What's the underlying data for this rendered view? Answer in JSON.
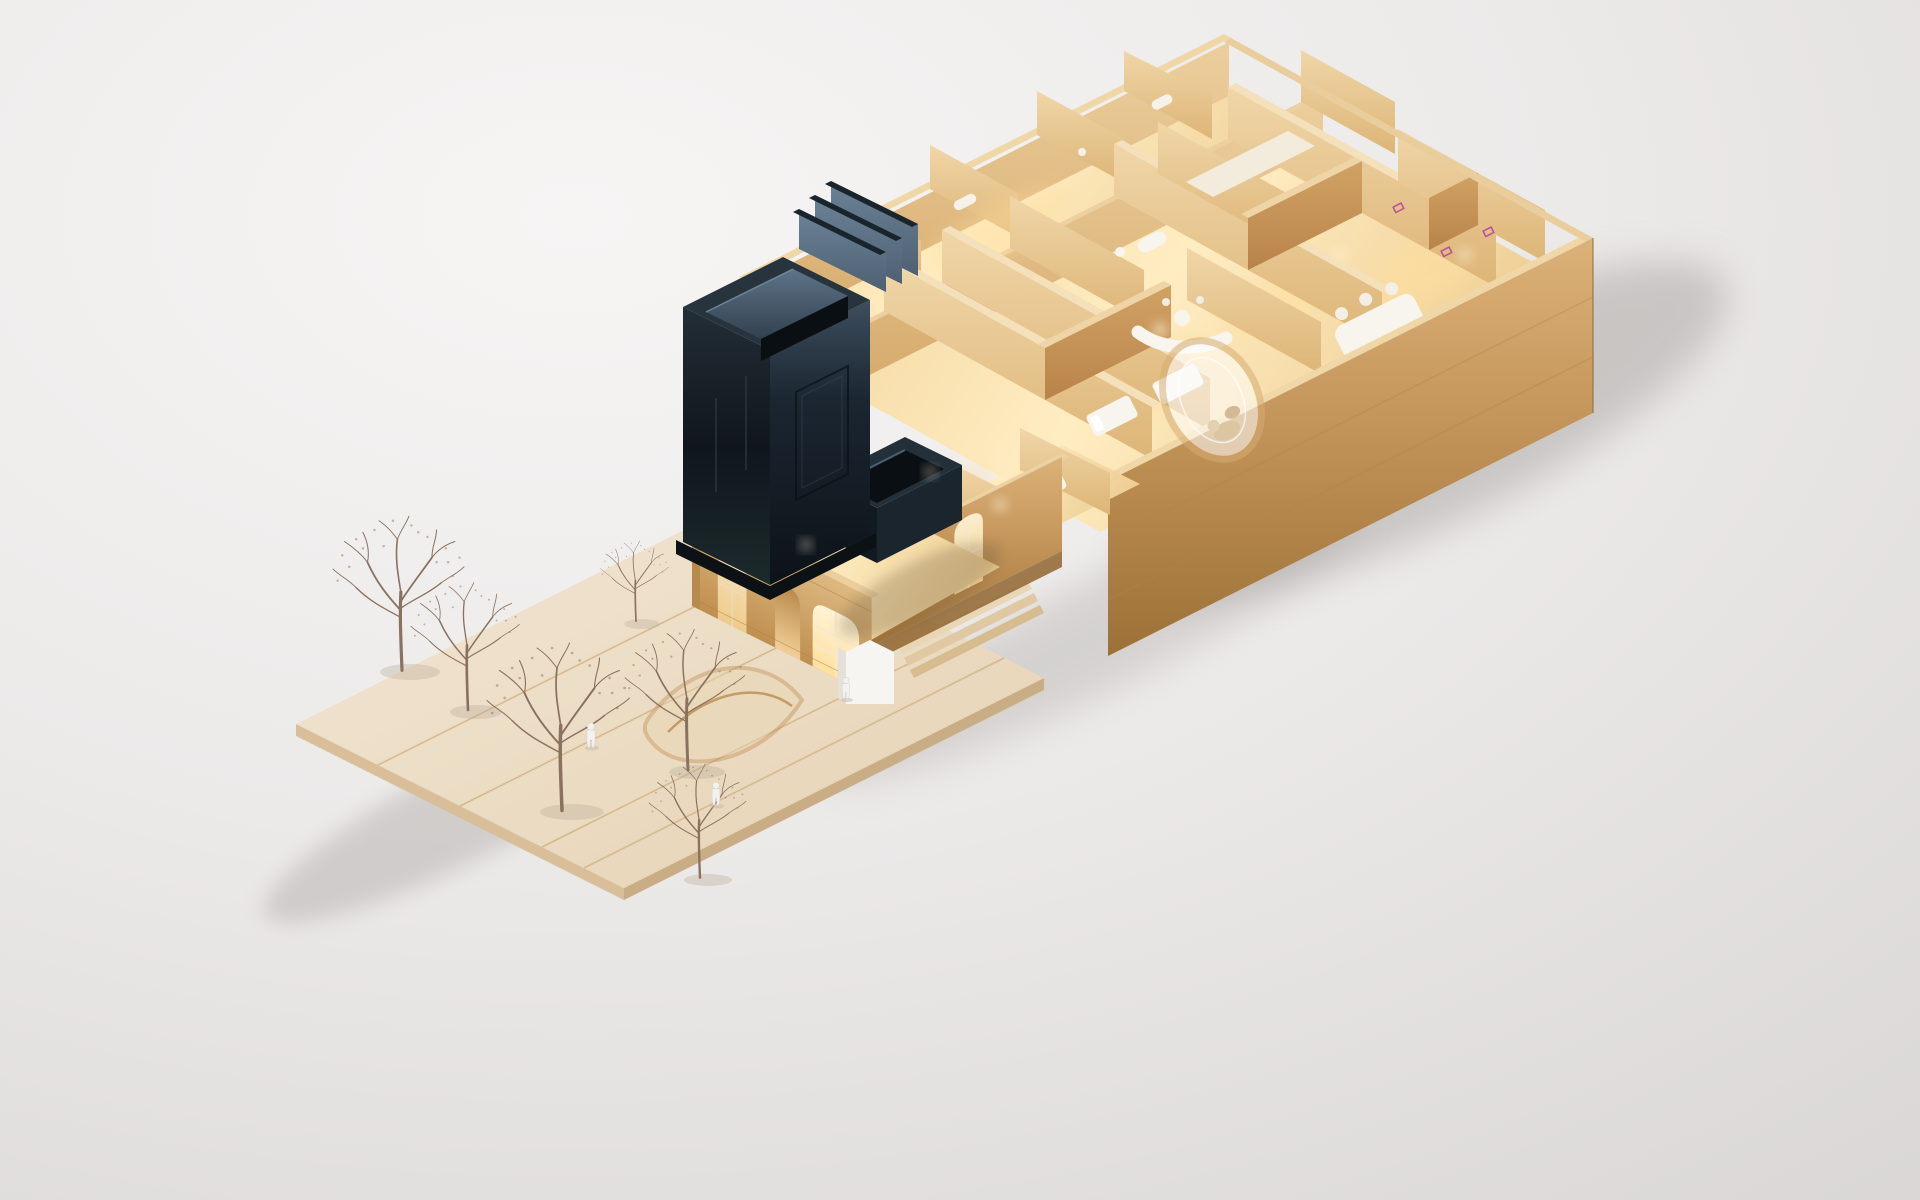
{
  "meta": {
    "subject": "architectural-scale-model-render",
    "view": "isometric",
    "visible_text": "none"
  },
  "scene": {
    "elements": [
      "plaza-deck",
      "winter-trees",
      "scale-figures",
      "curved-landform",
      "historic-facade",
      "entrance-porch",
      "mid-wing",
      "long-wing",
      "interior-partitions",
      "white-furniture",
      "glass-pod",
      "black-tower",
      "roof-fins",
      "annex-box",
      "cast-shadows"
    ],
    "counts": {
      "winter_trees": 6,
      "scale_figures": 3,
      "glowing_openings": 6
    }
  },
  "palette": {
    "bg_light": "#f6f5f4",
    "bg_mid": "#eceae9",
    "bg_dark": "#d7d4d3",
    "shadow": "#a8a3a0",
    "plaza_light": "#f2e7d6",
    "plaza_dark": "#e6d1b2",
    "plaza_side": "#d8bf99",
    "plaza_side_dark": "#c9ae85",
    "plaza_seam": "#d2b486",
    "ribbon": "#c2935a",
    "tree": "#8b7260",
    "figure": "#f4f2ef",
    "wood_rim": "#f0d7a8",
    "wood_face_light": "#eccf9e",
    "wood_face": "#d6aa6c",
    "wall_top": "#dcb279",
    "wall_mid": "#c3945a",
    "wall_bottom": "#9c7036",
    "floor_light": "#ffedc2",
    "floor_mid": "#f2d49c",
    "floor_dark": "#eccb90",
    "partition_light": "#f0d6a8",
    "partition_shade": "#ddb577",
    "partition_front": "#d2a264",
    "partition_front_dark": "#b8834a",
    "facade_top": "#ddb981",
    "facade_bottom": "#bf8f4f",
    "window_glow_light": "#fff3d6",
    "window_glow": "#ffdf9e",
    "lamp": "#fff4da",
    "furniture_white": "#f8f5ef",
    "tower_top_sheen": "#232e37",
    "tower_black": "#10161c",
    "tower_bottom": "#1c2a2c",
    "tower_side_light": "#3d4e5d",
    "tower_side": "#1b2631",
    "tower_side_dark": "#0d1218",
    "fin_light": "#6c8296",
    "fin_dark": "#4e6173",
    "court_light": "#5e7488",
    "court_dark": "#31404e",
    "pod_ring": "#d6ad72",
    "accent_magenta": "#b233a0"
  }
}
